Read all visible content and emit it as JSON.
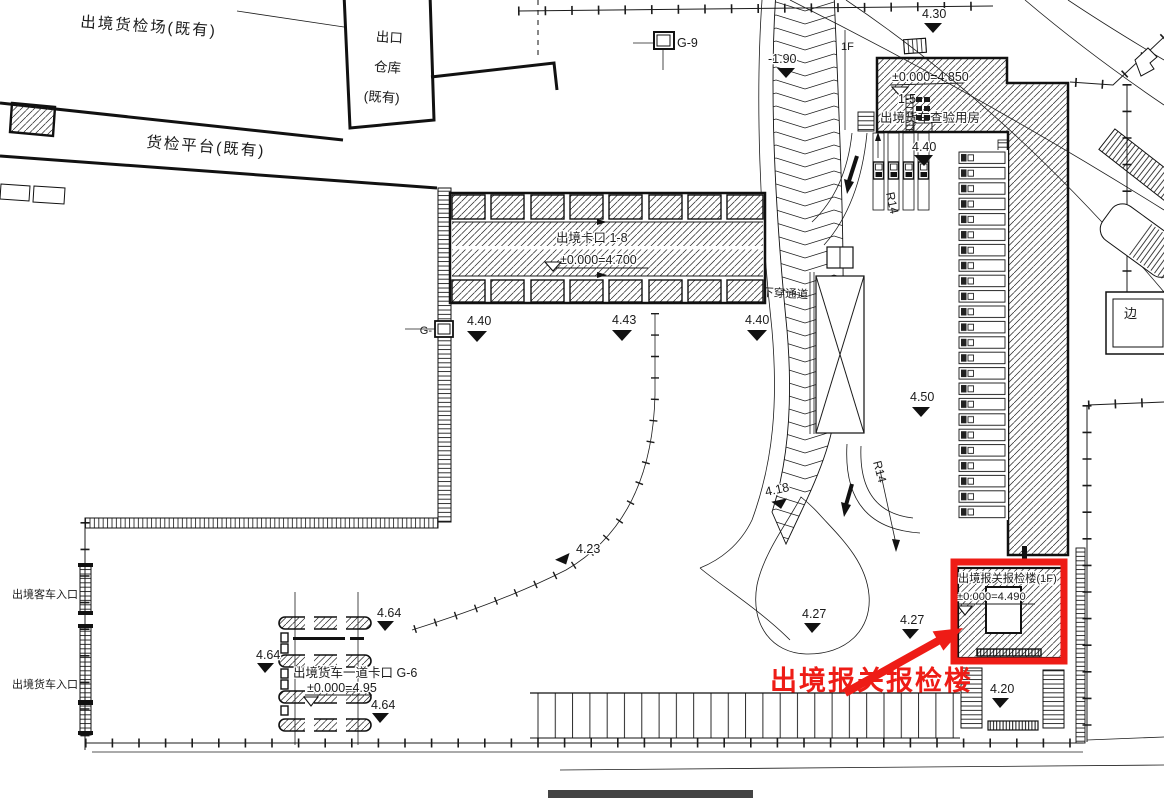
{
  "colors": {
    "accent_red": "#ee1c16",
    "line": "#1b1b1b",
    "paper": "#ffffff"
  },
  "existing": {
    "yard": "出境货检场(既有)",
    "warehouse_line1": "出口",
    "warehouse_line2": "仓库",
    "warehouse_line3": "(既有)",
    "platform": "货检平台(既有)"
  },
  "gates": {
    "kakou": "出境卡口 1-8",
    "kakou_elev": "±0.000=4.700",
    "g6": "出境货车一道卡口 G-6",
    "g6_elev": "±0.000=4.95",
    "g9": "G-9",
    "g_left": "G-"
  },
  "buildings": {
    "house_elev": "±0.000=4.850",
    "house_no": "1-5",
    "house": "出境货车查验用房",
    "customs": "出境报关报检楼(1F)",
    "customs_elev": "±0.000=4.490"
  },
  "entrances": {
    "bus": "出境客车入口",
    "truck": "出境货车入口"
  },
  "labels": {
    "annotation": "出境报关报检楼",
    "floor": "1F",
    "ramp": "下穿通道",
    "r14a": "R14",
    "r14b": "R14",
    "edge": "边"
  },
  "elevations": {
    "e440a": "4.40",
    "e443": "4.43",
    "e440b": "4.40",
    "e440c": "4.40",
    "e450": "4.50",
    "e430": "4.30",
    "em190": "-1.90",
    "e418": "4.18",
    "e423": "4.23",
    "e464a": "4.64",
    "e464b": "4.64",
    "e464c": "4.64",
    "e427a": "4.27",
    "e427b": "4.27",
    "e420": "4.20"
  }
}
